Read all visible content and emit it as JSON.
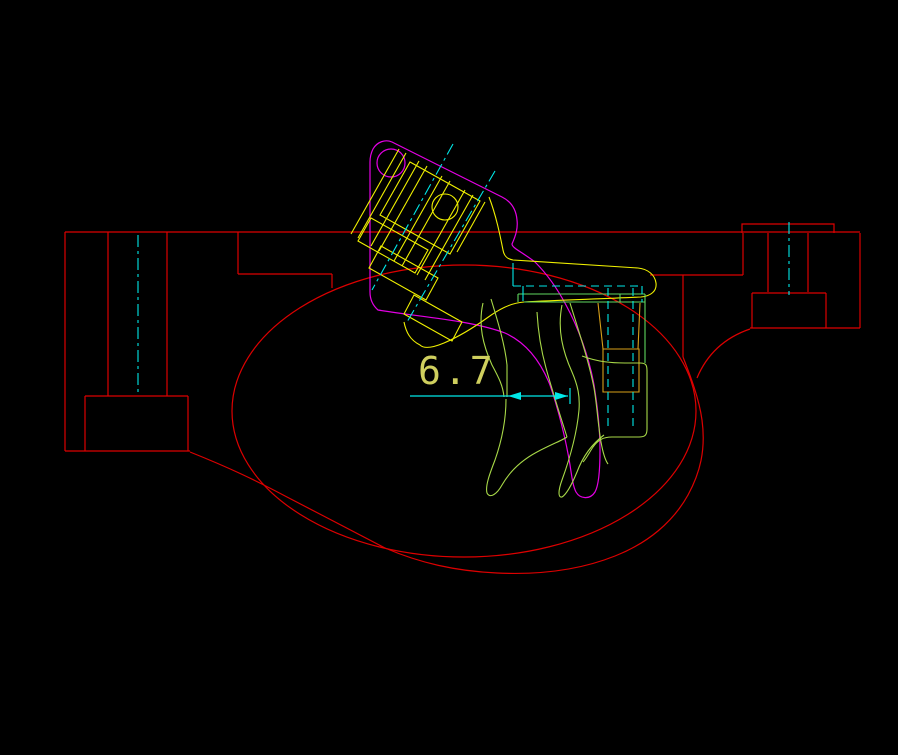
{
  "canvas": {
    "width": 898,
    "height": 755,
    "background": "#000000"
  },
  "dimension": {
    "value": "6.7",
    "x": 418,
    "y": 384,
    "size": 38,
    "color": "#cfcf5e"
  },
  "colors": {
    "receiver_red": "#dd0000",
    "bracket_magenta": "#e400e4",
    "hammer_yellow": "#f0f000",
    "trigger_green": "#a8d948",
    "bar_green": "#5fd85f",
    "centerline_cyan": "#00e8e8",
    "pin_orange": "#d8a018",
    "text_khaki": "#cfcf5e"
  },
  "layers": [
    {
      "name": "receiver-outline",
      "color": "#dd0000",
      "width": 1.2,
      "paths": [
        "M65,232 H860",
        "M65,232 V451",
        "M65,451 H190",
        "M108,232 V396",
        "M167,232 V396",
        "M85,396 H188",
        "M85,396 V451",
        "M188,396 V451",
        "M238,232 V274",
        "M238,274 H332",
        "M332,274 V288",
        "M650,275 H743",
        "M743,233 V275",
        "M768,233 V292",
        "M808,233 V292",
        "M742,233 V224 H834 V233",
        "M860,233 V328",
        "M750,328 H860",
        "M752,293 V328",
        "M752,293 H826",
        "M826,293 V328",
        "M750,329 Q712,342 697,378",
        "M683,275 V357",
        "M683,357 C690,375 699,398 702,420 C706,450 700,473 688,495 C673,522 648,543 615,556 C580,570 540,575 497,573 C455,571 420,563 385,548 C350,530 320,514 287,497 C255,480 230,468 190,452"
      ],
      "ellipses": [
        {
          "cx": 464,
          "cy": 411,
          "rx": 232,
          "ry": 146
        }
      ]
    },
    {
      "name": "bracket-magenta",
      "color": "#e400e4",
      "width": 1.2,
      "paths": [
        "M502,197 L392,142 C385,139 377,142 373,149 C371,153 370,157 370,162 L370,292 Q370,303 378,310 C420,317 470,320 505,333 C525,342 540,360 550,385 C558,408 566,440 570,465 C572,478 573,486 576,492 C580,499 590,500 595,492 C599,485 600,470 600,450 C600,430 598,410 594,385 C589,357 578,327 566,305 C556,286 545,272 535,262 C522,252 512,248 512,244 C516,235 518,228 517,220 C516,208 510,201 502,197"
      ],
      "circles": [
        {
          "cx": 391,
          "cy": 163,
          "r": 14
        }
      ]
    },
    {
      "name": "hammer-assembly",
      "color": "#f0f000",
      "width": 1.1,
      "paths": [
        "M399,149 L351,234",
        "M406,153 L358,238",
        "M419,161 L371,246",
        "M427,166 L379,251",
        "M442,176 L394,261",
        "M450,181 L402,266",
        "M465,190 L417,275",
        "M473,195 L425,280",
        "M485,202 L457,252",
        "M410,162 L480,201 L450,254 L380,215 Z",
        "M371,218 L428,250 L415,273 L358,241 Z",
        "M381,246 L438,278 L426,300 L369,268 Z",
        "M414,295 L462,322 L452,341 L404,314 Z",
        "M489,197 C496,215 500,235 503,250 C504,256 507,259 513,260 C560,263 610,266 638,268 C648,269 655,275 656,283 C657,291 651,296 641,297 C600,299 560,300 524,302 C510,303 498,310 487,318 C473,328 458,337 444,343 C432,348 424,349 420,345 C410,340 406,332 404,322"
      ],
      "circles": [
        {
          "cx": 445,
          "cy": 207,
          "r": 13
        }
      ]
    },
    {
      "name": "sear-pin",
      "color": "#d8a018",
      "width": 1.1,
      "paths": [
        "M598,303 L603,349",
        "M640,303 L638,349",
        "M603,349 H639 V392 H603 Z"
      ]
    },
    {
      "name": "trigger-green",
      "color": "#a8d948",
      "width": 1.1,
      "paths": [
        "M483,303 C478,325 483,345 492,365 C499,378 503,386 504,397",
        "M491,299 C498,322 505,345 507,365 L507,397",
        "M506,399 C506,420 502,440 495,460 C490,473 485,486 487,493 C490,499 497,494 502,485 C510,471 522,460 537,452 C552,444 563,440 567,437",
        "M567,437 C560,415 552,390 546,368 C541,350 538,330 537,312",
        "M562,305 C557,330 563,352 572,372 C578,386 580,396 579,410 C577,432 570,458 562,480 C558,491 558,498 562,497 C567,494 572,484 577,472 C583,456 592,444 604,435",
        "M570,303 C579,332 589,362 594,388 C597,405 598,425 601,442 C603,453 605,460 608,464",
        "M582,356 C598,362 612,363 625,363 L640,363 C646,363 647,365 647,371 L647,429 C647,435 645,437 639,437 L612,437 C603,437 598,440 593,447 C589,453 586,459 583,462"
      ]
    },
    {
      "name": "trigger-bar",
      "color": "#5fd85f",
      "width": 1.1,
      "paths": [
        "M518,294 H645",
        "M524,302 H645",
        "M518,294 V302",
        "M620,294 V302",
        "M645,294 V363"
      ]
    },
    {
      "name": "centerlines",
      "color": "#00e8e8",
      "width": 1.1,
      "dash": "12 4 3 4",
      "paths": [
        "M138,235 V394",
        "M789,222 V295",
        "M453,144 L372,290",
        "M495,171 L407,322"
      ]
    },
    {
      "name": "hidden-lines",
      "color": "#00e8e8",
      "width": 1.1,
      "dash": "8 5",
      "paths": [
        "M513,286 H642",
        "M608,288 V430",
        "M633,288 V430",
        "M642,286 V302"
      ]
    },
    {
      "name": "hidden-steps",
      "color": "#00e8e8",
      "width": 1.1,
      "paths": [
        "M513,263 V286",
        "M523,286 V301"
      ]
    },
    {
      "name": "dimension-lines",
      "color": "#00e8e8",
      "width": 1.2,
      "paths": [
        "M410,396 H568",
        "M570,388 V404"
      ],
      "polygons": [
        {
          "points": "508,396 521,392 521,400"
        },
        {
          "points": "568,396 555,392 555,400"
        }
      ]
    }
  ]
}
